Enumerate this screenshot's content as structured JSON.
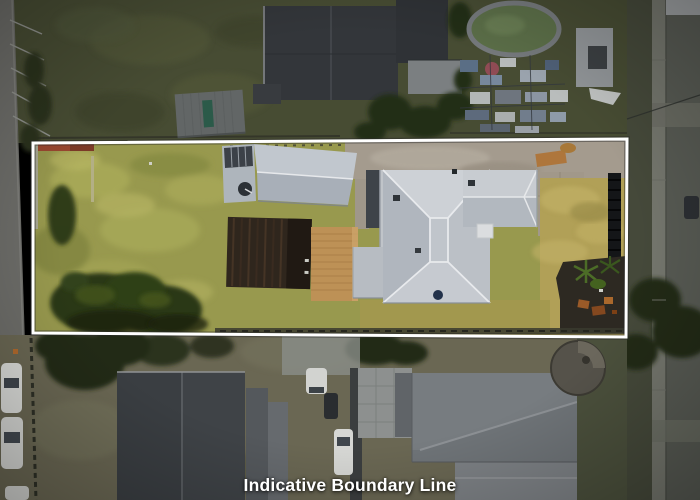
{
  "overlay": {
    "caption": "Indicative Boundary Line",
    "colors": {
      "boundary": "#ffffff",
      "caption": "#ffffff"
    }
  },
  "scene": {
    "kind": "aerial drone photo of a residential lot",
    "highlight": "subject lot outlined in white; surroundings darkened",
    "subject_lot": [
      "yellow-green lawn (left half)",
      "garage with grey gable roof",
      "dark brown shed roof",
      "timber deck",
      "main house with light grey hip roof",
      "concrete driveway with orange dirt patches",
      "dry yellow lawn (right)",
      "dark garden bed with palms (bottom right)",
      "tree canopy (bottom left)",
      "red hedge strip (top left)",
      "black pool fence (right)"
    ],
    "surroundings": [
      "street with parked white cars (left)",
      "street and footpath (right)",
      "neighbouring dark charcoal roofs (top)",
      "oval swimming pool with green water",
      "cluttered backyard with blue tarps",
      "small grey-roofed shed",
      "large dark gable roof (bottom)",
      "grey warehouse roofs (bottom right)",
      "round concrete water tank",
      "white vans in driveway (bottom centre)",
      "dark green trees"
    ]
  }
}
